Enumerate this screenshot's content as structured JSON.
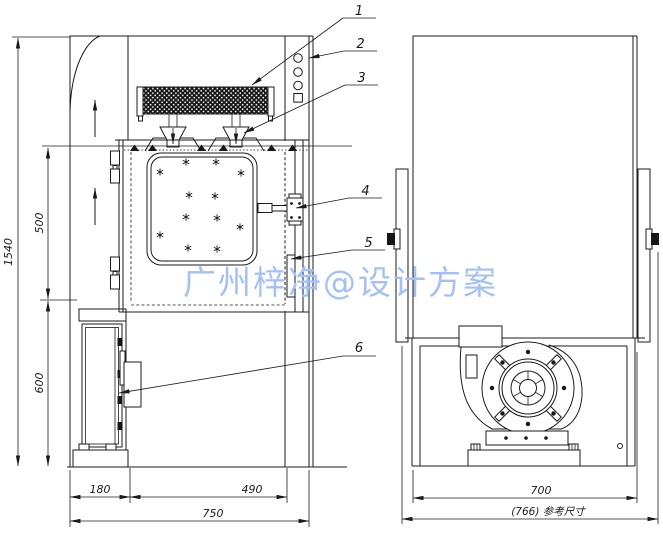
{
  "watermark": {
    "text": "广州梓净@设计方案",
    "color": "#a3c1f7"
  },
  "front": {
    "dims": {
      "h_total": "1540",
      "h_upper": "500",
      "h_lower": "600",
      "w_left": "180",
      "w_door": "490",
      "w_total": "750"
    },
    "callouts": [
      "1",
      "2",
      "3",
      "4",
      "5",
      "6"
    ]
  },
  "side": {
    "dims": {
      "depth": "700",
      "reference": "(766) 参考尺寸"
    }
  },
  "colors": {
    "line": "#1b1b1b",
    "watermark": "#a3c1f7",
    "filter_fill": "#161616"
  }
}
